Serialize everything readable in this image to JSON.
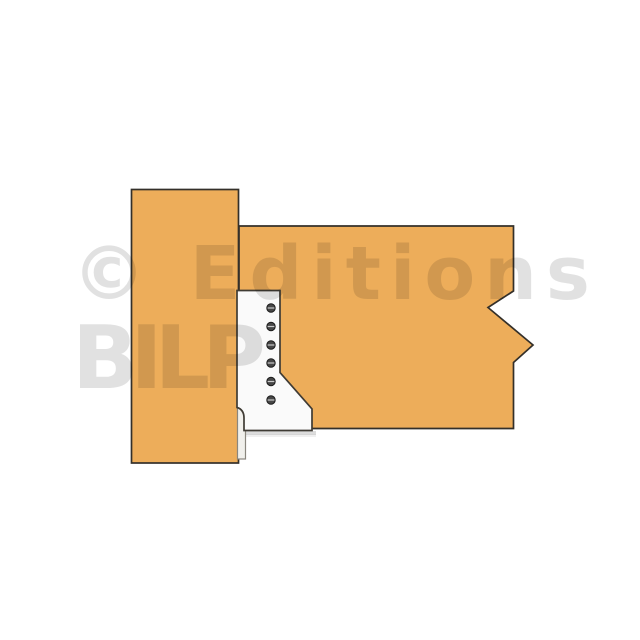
{
  "illustration": {
    "watermark": {
      "line1": "© Editions",
      "line2": "BILP"
    },
    "colors": {
      "background": "#ffffff",
      "wood": "#EDAD5A",
      "outline": "#34302A",
      "hanger_fill": "#FAFAFA",
      "hanger_edge": "#3F3B34",
      "hanger_tab_fill": "#F1F0EC",
      "hanger_tab_edge": "#8A867E",
      "screw_fill": "#474747",
      "screw_edge": "#1A1A1A",
      "screw_slot": "#C9C9C9",
      "watermark_color": "#000000"
    },
    "screws": {
      "count": 6
    }
  }
}
